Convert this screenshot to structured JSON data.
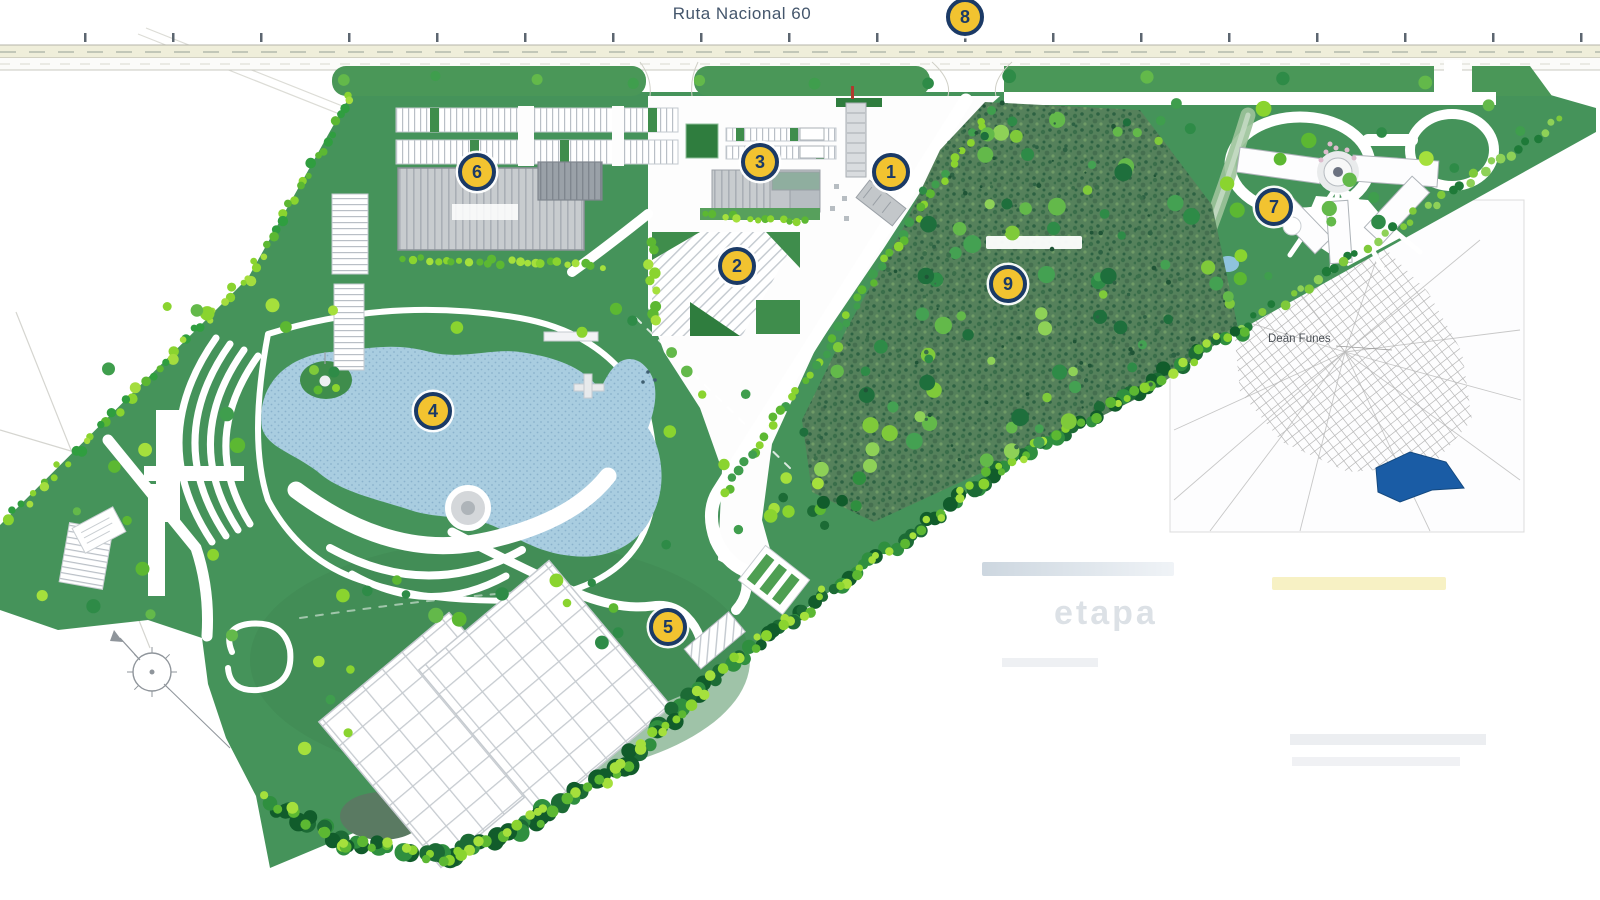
{
  "road": {
    "label": "Ruta Nacional 60"
  },
  "markers": [
    {
      "n": "1"
    },
    {
      "n": "2"
    },
    {
      "n": "3"
    },
    {
      "n": "4"
    },
    {
      "n": "5"
    },
    {
      "n": "6"
    },
    {
      "n": "7"
    },
    {
      "n": "8"
    },
    {
      "n": "9"
    }
  ],
  "inset": {
    "city": "Deán Funes"
  },
  "legend": {
    "phase": "etapa"
  },
  "colors": {
    "marker_fill": "#F2C330",
    "marker_ring": "#1B3A66",
    "park_green": "#45935A",
    "forest_green": "#55815B",
    "tree_bright": "#8AD42F",
    "lake_blue": "#A9CDE0",
    "road_cream": "#EFEEDA",
    "inset_site_blue": "#1A5CA5"
  }
}
